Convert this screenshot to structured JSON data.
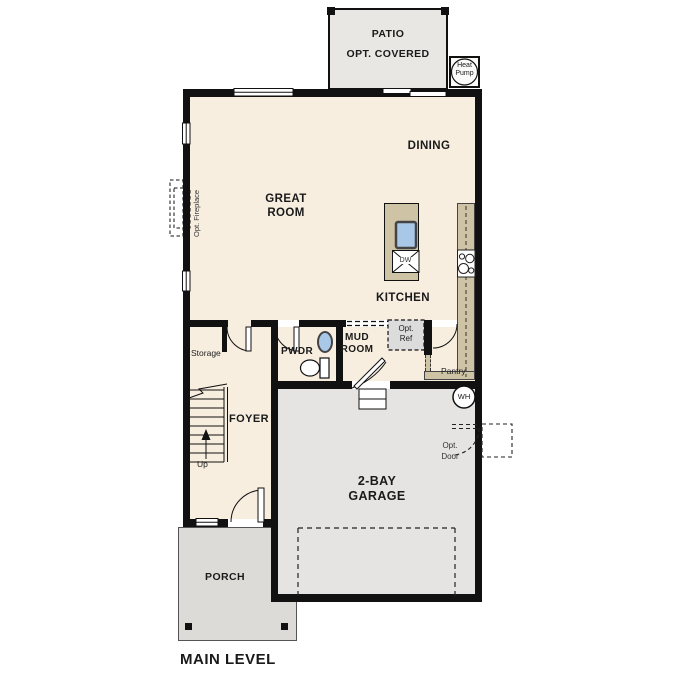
{
  "plan": {
    "title": "MAIN LEVEL",
    "rooms": {
      "patio": "PATIO",
      "patio_option": "OPT. COVERED",
      "dining": "DINING",
      "great_room_line1": "GREAT",
      "great_room_line2": "ROOM",
      "kitchen": "KITCHEN",
      "mud_room_line1": "MUD",
      "mud_room_line2": "ROOM",
      "powder": "PWDR",
      "foyer": "FOYER",
      "storage": "Storage",
      "pantry": "Pantry",
      "garage_line1": "2-BAY",
      "garage_line2": "GARAGE",
      "porch": "PORCH"
    },
    "annotations": {
      "heat_pump_line1": "Heat",
      "heat_pump_line2": "Pump",
      "opt_fireplace": "Opt. Fireplace",
      "opt_ref_line1": "Opt.",
      "opt_ref_line2": "Ref",
      "opt_door_line1": "Opt.",
      "opt_door_line2": "Door",
      "water_heater": "WH",
      "dishwasher": "DW",
      "stairs_direction": "Up"
    },
    "colors": {
      "wall": "#111111",
      "room_fill": "#f7eee0",
      "garage_fill": "#e5e4e2",
      "patio_fill": "#e8e7e4",
      "porch_fill": "#dcdbd8",
      "counter_fill": "#cfc3a6",
      "sink_fill": "#a9c7e6",
      "opt_ref_fill": "#dcdcdc"
    }
  }
}
